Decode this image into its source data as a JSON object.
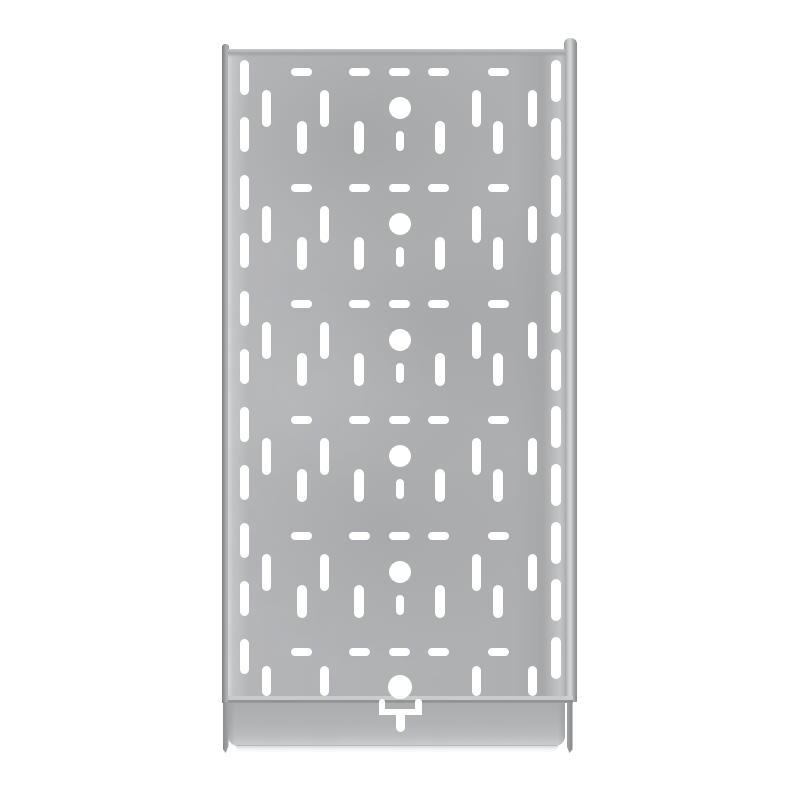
{
  "scene": {
    "description": "Product photograph of a galvanized steel perforated cable tray segment with an end coupler plate, shot from directly above on a plain white background",
    "object": "perforated-cable-tray",
    "orientation": "vertical",
    "visible_text": ""
  },
  "colors": {
    "background": "#ffffff",
    "panel_base": "#b1b2b4",
    "panel_light": "#dadbdc",
    "panel_dark": "#a7a8aa",
    "rail_dark": "#86878a",
    "rail_light": "#d7d8da",
    "seam_light": "#cdced0",
    "seam_dark": "#898a8c",
    "coupler_base": "#b3b4b6",
    "hole": "#ffffff"
  },
  "pattern": {
    "period": 116,
    "horizontal_slots": {
      "rows": 6,
      "first_center_y": 72,
      "centers_x": [
        301,
        359,
        399,
        438.5,
        498
      ],
      "width": 21,
      "height": 8.5
    },
    "long_vertical_slots": {
      "rows": 6,
      "first_center_y": 108.5,
      "centers_x": [
        266.5,
        324,
        476,
        532.5
      ],
      "width": 9,
      "height": 37,
      "last_row_center_y": 681,
      "last_row_height": 30
    },
    "center_circles": {
      "rows": 6,
      "first_center_y": 108,
      "center_x": 399.5,
      "radius": 11,
      "last_row_center_y": 687,
      "last_row_radius": 12
    },
    "offset_vertical_slots": {
      "rows": 5,
      "first_center_y": 137,
      "centers_x": [
        302,
        359,
        440,
        498
      ],
      "width": 9.5,
      "height": 33
    },
    "short_center_slots": {
      "rows": 5,
      "first_center_y": 141,
      "center_x": 399.5,
      "width": 8,
      "height": 20
    },
    "left_flange_slots": {
      "count": 11,
      "center_x": 244,
      "first_center_y": 77,
      "spacing": 57.9,
      "width": 9,
      "height": 35
    },
    "right_flange_slots": {
      "count": 11,
      "center_x": 556,
      "first_center_y": 81,
      "spacing": 57.7,
      "width": 10,
      "height": 42
    },
    "t_slot_cutout": {
      "parts": [
        {
          "name": "t-slot-left-bar",
          "x": 378.5,
          "y": 699,
          "w": 6.5,
          "h": 16,
          "r": "3px 3px 0 0"
        },
        {
          "name": "t-slot-right-bar",
          "x": 415,
          "y": 699,
          "w": 6.5,
          "h": 16,
          "r": "3px 3px 0 0"
        },
        {
          "name": "t-slot-cross-bar",
          "x": 378.5,
          "y": 708.5,
          "w": 43,
          "h": 6.5,
          "r": "2px"
        },
        {
          "name": "t-slot-stem",
          "x": 395.5,
          "y": 712,
          "w": 9,
          "h": 20,
          "r": "0 0 4.5px 4.5px"
        }
      ]
    }
  }
}
